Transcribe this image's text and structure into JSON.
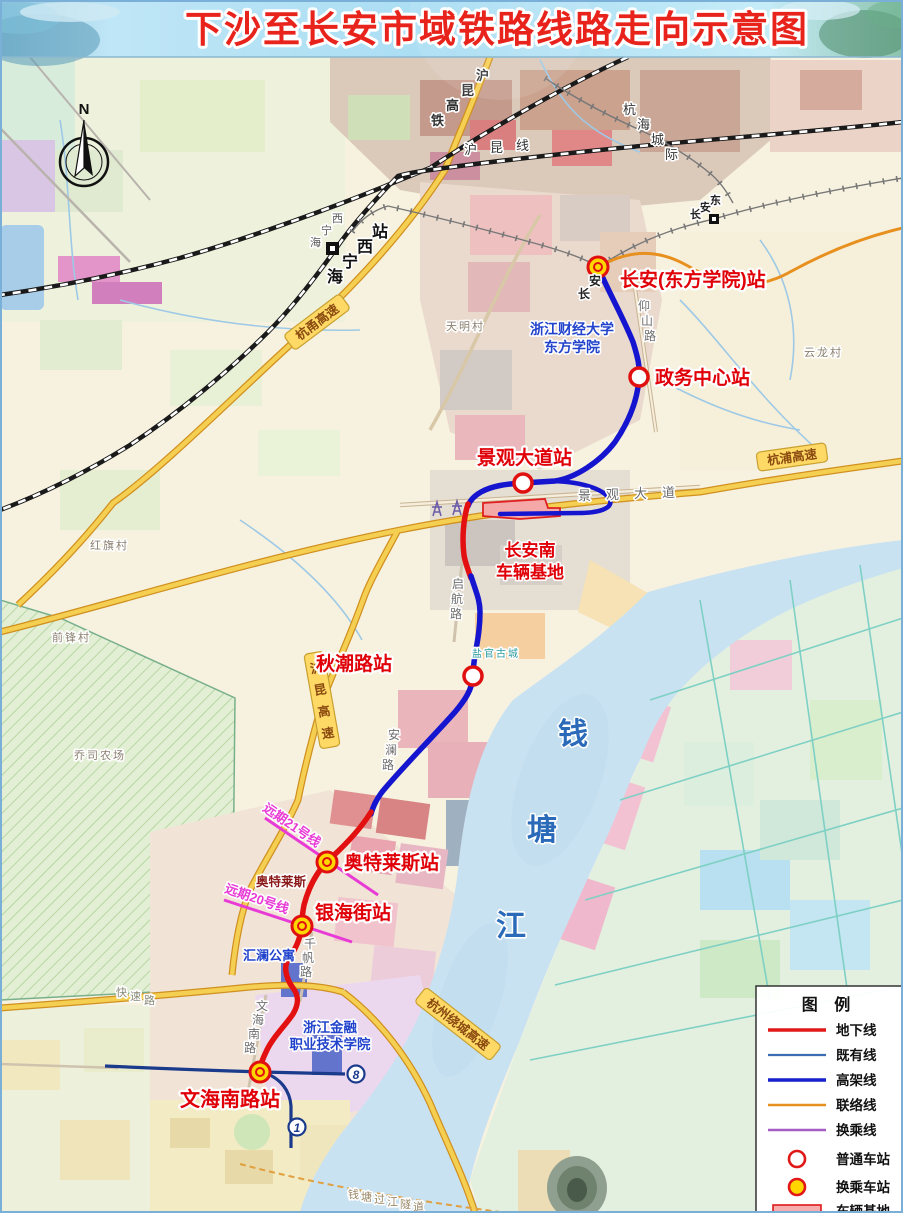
{
  "title": "下沙至长安市域铁路线路走向示意图",
  "compass": {
    "north": "N"
  },
  "stations": {
    "changan": "长安(东方学院)站",
    "zhengwu": "政务中心站",
    "jingguan": "景观大道站",
    "qiuchao": "秋潮路站",
    "aotelaisi": "奥特莱斯站",
    "yinhai": "银海街站",
    "wenhai": "文海南路站"
  },
  "depot": {
    "line1": "长安南",
    "line2": "车辆基地"
  },
  "future_lines": {
    "line21": "远期21号线",
    "line20": "远期20号线"
  },
  "metro_badges": {
    "line8": "8",
    "line1": "1"
  },
  "railways": {
    "hukun_hsr": "沪昆高铁",
    "hukun_line": "沪昆线",
    "hanghai": "杭海城际"
  },
  "rail_stations": {
    "haining_west_station": "海宁西站",
    "haining_west": "海宁西",
    "changan_east": "长安东",
    "changan_rail": "长安"
  },
  "highways": {
    "hangyong": "杭甬高速",
    "hukun_expwy": "沪昆高速",
    "hangpu": "杭浦高速",
    "raocheng": "杭州绕城高速",
    "kuaisulu": "快速路",
    "tunnel": "钱塘过江隧道"
  },
  "roads": {
    "yangshan": "仰山路",
    "qihang": "启航路",
    "anlan": "安澜路",
    "qianfan": "千帆路",
    "wenhai_road": "文海南路",
    "jingguan_avenue": "景观大道"
  },
  "river": {
    "name": "钱塘江"
  },
  "villages": {
    "tianming": "天明村",
    "hongqi": "红旗村",
    "qianfeng": "前锋村",
    "yunlong": "云龙村",
    "farm": "乔司农场",
    "yanguan": "盐官古城"
  },
  "landmarks": {
    "caijing_l1": "浙江财经大学",
    "caijing_l2": "东方学院",
    "outlets": "奥特莱斯",
    "huilan": "汇澜公寓",
    "jinrong_l1": "浙江金融",
    "jinrong_l2": "职业技术学院"
  },
  "legend": {
    "title": "图  例",
    "underground": "地下线",
    "existing": "既有线",
    "elevated": "高架线",
    "connecting": "联络线",
    "transfer_line": "换乘线",
    "ordinary_station": "普通车站",
    "transfer_station": "换乘车站",
    "depot": "车辆基地"
  },
  "colors": {
    "underground_line": "#e21010",
    "existing_line": "#1a3a8c",
    "elevated_line": "#1515cf",
    "connecting_line": "#e8901f",
    "transfer_line": "#a55fc4",
    "future_line": "#e83bd6",
    "station_ring": "#e01010",
    "transfer_station_fill": "#ffd700",
    "title_red": "#e8231c",
    "river_blue": "#c9e2f2"
  }
}
